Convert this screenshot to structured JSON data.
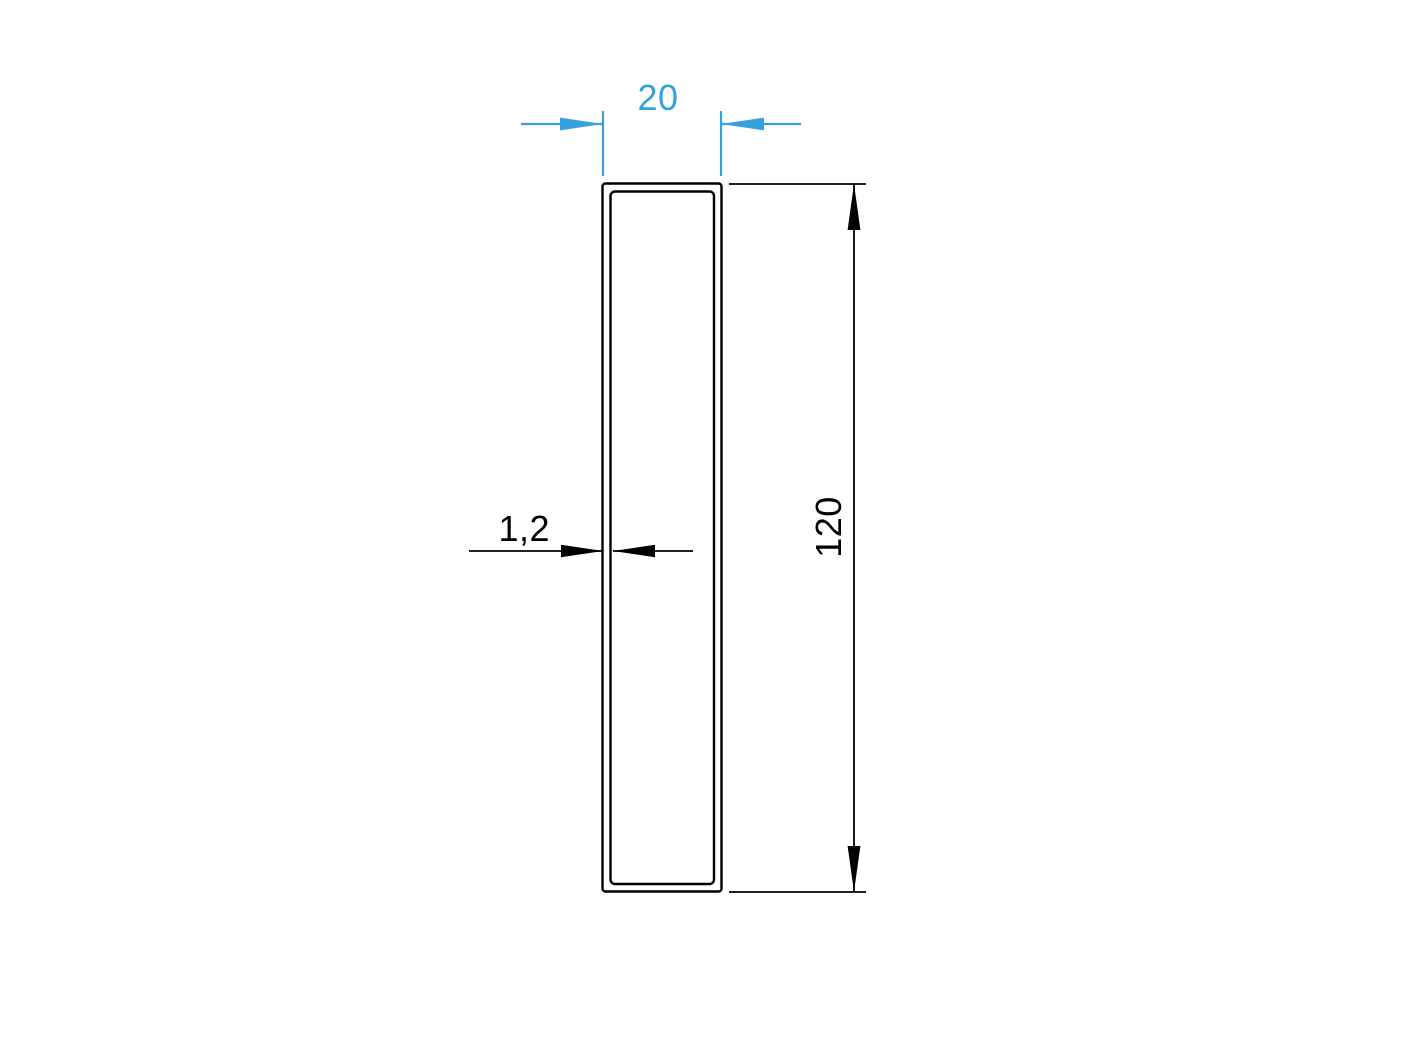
{
  "drawing": {
    "dimensions": {
      "width": {
        "label": "20"
      },
      "height": {
        "label": "120"
      },
      "wall_thickness": {
        "label": "1,2"
      }
    },
    "colors": {
      "width_dimension_blue": "#36A1DC",
      "height_dimension_black": "#000000",
      "outline_black": "#000000",
      "background": "#FFFFFF"
    }
  }
}
